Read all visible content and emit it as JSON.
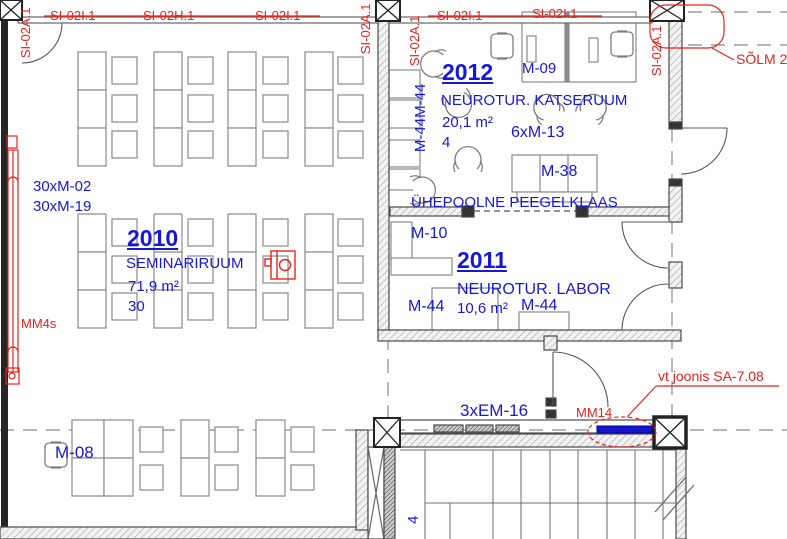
{
  "colors": {
    "annotation_blue": "#1717d6",
    "annotation_red": "#e8231e"
  },
  "rooms": {
    "r2010": {
      "number": "2010",
      "name": "SEMINARIRUUM",
      "area": "71,9 m²",
      "capacity": "30"
    },
    "r2011": {
      "number": "2011",
      "name": "NEUROTUR. LABOR",
      "area": "10,6 m²"
    },
    "r2012": {
      "number": "2012",
      "name": "NEUROTUR. KATSERUUM",
      "area": "20,1 m²",
      "capacity": "4"
    }
  },
  "wall_tags": {
    "h": [
      "SI-02I.1",
      "SI-02H.1",
      "SI-02I.1",
      "SI-02I.1",
      "SI-02I.1"
    ],
    "v": [
      "SI-02A.1",
      "SI-02A.1",
      "SI-02A.1",
      "SI-02A.1"
    ]
  },
  "furniture_tags": {
    "m02": "30xM-02",
    "m19": "30xM-19",
    "m08": "M-08",
    "m09": "M-09",
    "m10": "M-10",
    "m13": "6xM-13",
    "m38": "M-38",
    "m44_pair": "M-44M-44",
    "m44_left": "M-44",
    "m44_right": "M-44",
    "em16": "3xEM-16",
    "stair": "4"
  },
  "annotations": {
    "solm": "SÕLM 2",
    "mm4s": "MM4s",
    "mm14": "MM14",
    "vt_joonis": "vt joonis SA-7.08",
    "mirror_note": "ÜHEPOOLNE PEEGELKLAAS"
  }
}
